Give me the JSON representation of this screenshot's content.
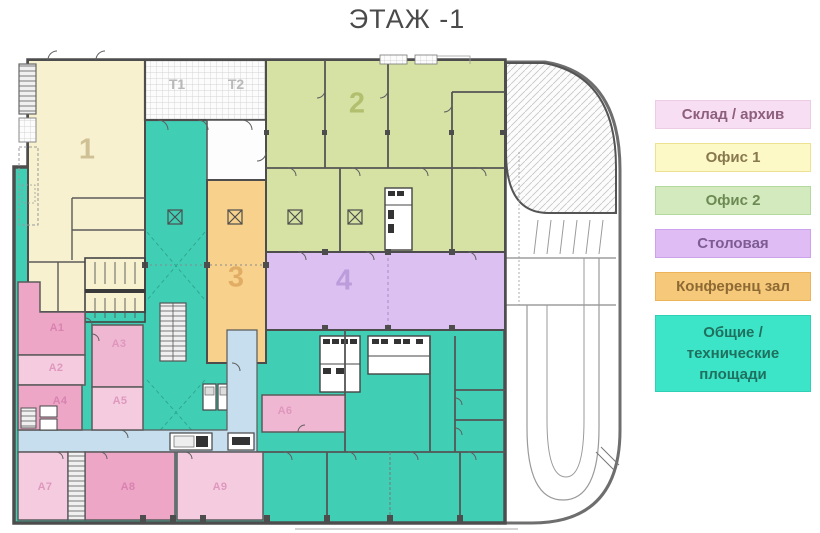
{
  "title": "ЭТАЖ -1",
  "legend": {
    "items": [
      {
        "label": "Склад / архив",
        "color": "#f8def3",
        "border": "#eccbe5",
        "text_color": "#8d5f7d"
      },
      {
        "label": "Офис 1",
        "color": "#fdf9c6",
        "border": "#ece291",
        "text_color": "#87784e"
      },
      {
        "label": "Офис 2",
        "color": "#d3eabf",
        "border": "#b4d99e",
        "text_color": "#6d8a52"
      },
      {
        "label": "Столовая",
        "color": "#dfbcf4",
        "border": "#cda2ec",
        "text_color": "#7d5b93"
      },
      {
        "label": "Конференц зал",
        "color": "#f6c87a",
        "border": "#edb35b",
        "text_color": "#8d6a33"
      },
      {
        "label": "Общие / технические площади",
        "color": "#3ce5c8",
        "border": "#2fd0b3",
        "text_color": "#20705f"
      }
    ]
  },
  "plan": {
    "colors": {
      "office1": "#f8f1cf",
      "office2": "#d6e2a3",
      "conference": "#f8d28d",
      "dining": "#dbc0f1",
      "common": "#40cfb5",
      "storage_dark": "#eda6c6",
      "storage_mid": "#f0b7d3",
      "storage_light": "#f4cbdf",
      "corridor": "#c7deee",
      "wall": "#4d4d4d"
    },
    "labels": [
      {
        "id": "room-1",
        "text": "1"
      },
      {
        "id": "zone-t1",
        "text": "T1"
      },
      {
        "id": "zone-t2",
        "text": "T2"
      },
      {
        "id": "room-2",
        "text": "2"
      },
      {
        "id": "room-3",
        "text": "3"
      },
      {
        "id": "room-4",
        "text": "4"
      },
      {
        "id": "room-a1",
        "text": "A1"
      },
      {
        "id": "room-a2",
        "text": "A2"
      },
      {
        "id": "room-a3",
        "text": "A3"
      },
      {
        "id": "room-a4",
        "text": "A4"
      },
      {
        "id": "room-a5",
        "text": "A5"
      },
      {
        "id": "room-a6",
        "text": "A6"
      },
      {
        "id": "room-a7",
        "text": "A7"
      },
      {
        "id": "room-a8",
        "text": "A8"
      },
      {
        "id": "room-a9",
        "text": "A9"
      }
    ]
  }
}
